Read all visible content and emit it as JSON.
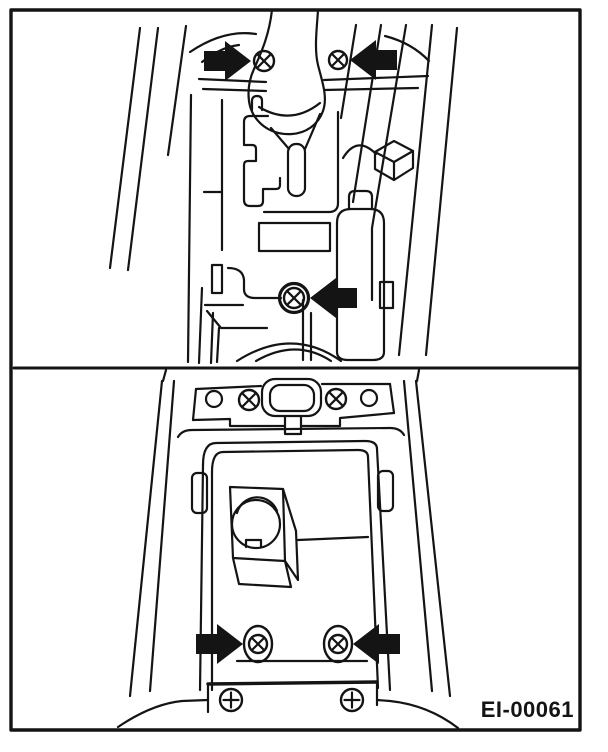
{
  "diagram": {
    "code_label": "EI-00061",
    "ink_color": "#141414",
    "background": "#ffffff",
    "panels": {
      "top": {
        "name": "console-shift-lever-view",
        "markers": {
          "screws": [
            {
              "x": 264,
              "y": 61,
              "r": 10,
              "style": "x",
              "washer": "none"
            },
            {
              "x": 338,
              "y": 60,
              "r": 9,
              "style": "x",
              "washer": "none"
            },
            {
              "x": 294,
              "y": 298,
              "r": 10,
              "style": "x",
              "washer": "ring"
            }
          ],
          "arrows": [
            {
              "x": 251,
              "y": 61,
              "dir": "right"
            },
            {
              "x": 350,
              "y": 60,
              "dir": "left"
            },
            {
              "x": 310,
              "y": 298,
              "dir": "left"
            }
          ]
        }
      },
      "bottom": {
        "name": "console-box-rear-view",
        "markers": {
          "screws": [
            {
              "x": 249,
              "y": 400,
              "r": 10,
              "style": "x",
              "washer": "none"
            },
            {
              "x": 336,
              "y": 399,
              "r": 10,
              "style": "x",
              "washer": "none"
            },
            {
              "x": 258,
              "y": 644,
              "r": 9,
              "style": "x",
              "washer": "oval"
            },
            {
              "x": 338,
              "y": 644,
              "r": 9,
              "style": "x",
              "washer": "oval"
            },
            {
              "x": 231,
              "y": 700,
              "r": 11,
              "style": "plus",
              "washer": "none"
            },
            {
              "x": 352,
              "y": 700,
              "r": 11,
              "style": "plus",
              "washer": "none"
            }
          ],
          "arrows": [
            {
              "x": 243,
              "y": 644,
              "dir": "right"
            },
            {
              "x": 353,
              "y": 644,
              "dir": "left"
            }
          ]
        }
      }
    }
  }
}
